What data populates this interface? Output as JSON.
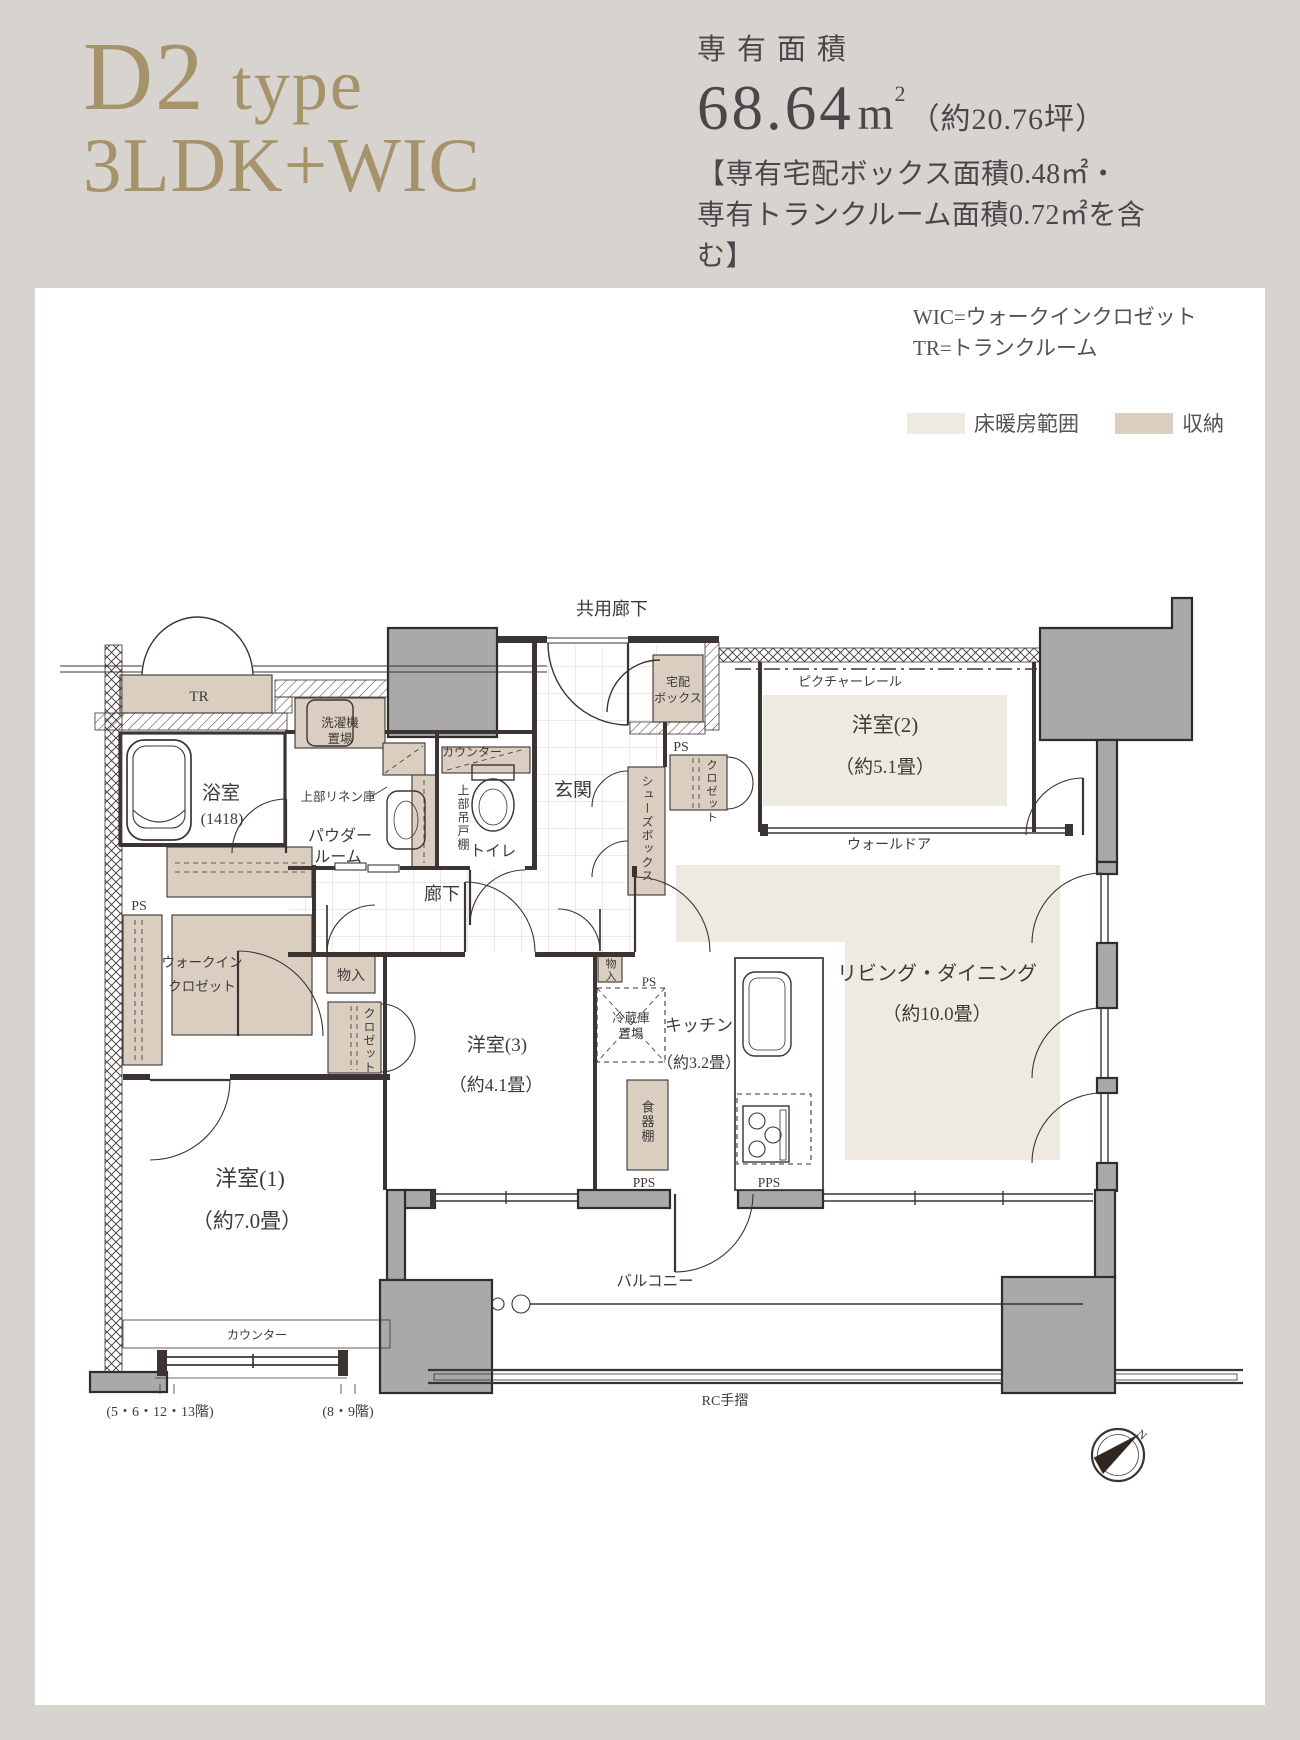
{
  "colors": {
    "accent": "#a7936b",
    "ink": "#4a474b",
    "line": "#3b3432",
    "heat": "#efeae1",
    "storage": "#d9cec0",
    "column_gray": "#a9a9a9",
    "page_bg": "#d7d3cf",
    "card_bg": "#ffffff"
  },
  "header": {
    "type_name": "D2",
    "type_suffix": "type",
    "layout": "3LDK+WIC",
    "area_label": "専有面積",
    "area_value": "68.64",
    "area_unit_base": "m",
    "area_unit_sup": "2",
    "area_tsubo": "（約20.76坪）",
    "note_line1": "【専有宅配ボックス面積0.48㎡・",
    "note_line2": "専有トランクルーム面積0.72㎡を含む】"
  },
  "legend": {
    "wic": "WIC=ウォークインクロゼット",
    "tr": "TR=トランクルーム",
    "floor_heating_label": "床暖房範囲",
    "storage_label": "収納"
  },
  "plan": {
    "labels": {
      "common_corridor": "共用廊下",
      "tr": "TR",
      "delivery1": "宅配",
      "delivery2": "ボックス",
      "picture_rail": "ピクチャーレール",
      "ps_top": "PS",
      "ps_left": "PS",
      "ps_center": "PS",
      "closet_top": "クロゼット",
      "closet_left": "クロゼット",
      "room2_name": "洋室(2)",
      "room2_size": "（約5.1畳）",
      "wall_door": "ウォールドア",
      "washer1": "洗濯機",
      "washer2": "置場",
      "bath_name": "浴室",
      "bath_size": "(1418)",
      "upper_linen": "上部リネン庫",
      "powder1": "パウダー",
      "powder2": "ルーム",
      "counter_toilet": "カウンター",
      "upper_cabinet": "上部吊戸棚",
      "toilet": "トイレ",
      "entrance": "玄関",
      "shoe_box": "シューズボックス",
      "hallway": "廊下",
      "wic_line1": "ウォークイン",
      "wic_line2": "クロゼット",
      "storage_left": "物入",
      "storage_center": "物入",
      "room3_name": "洋室(3)",
      "room3_size": "（約4.1畳）",
      "fridge1": "冷蔵庫",
      "fridge2": "置場",
      "kitchen_name": "キッチン",
      "kitchen_size": "（約3.2畳）",
      "cupboard": "食器棚",
      "ld_name": "リビング・ダイニング",
      "ld_size": "（約10.0畳）",
      "room1_name": "洋室(1)",
      "room1_size": "（約7.0畳）",
      "counter_bottom": "カウンター",
      "floors_a": "(5・6・12・13階)",
      "floors_b": "(8・9階)",
      "balcony": "バルコニー",
      "pps_left": "PPS",
      "pps_right": "PPS",
      "rc_rail": "RC手摺",
      "compass_n": "N"
    }
  }
}
